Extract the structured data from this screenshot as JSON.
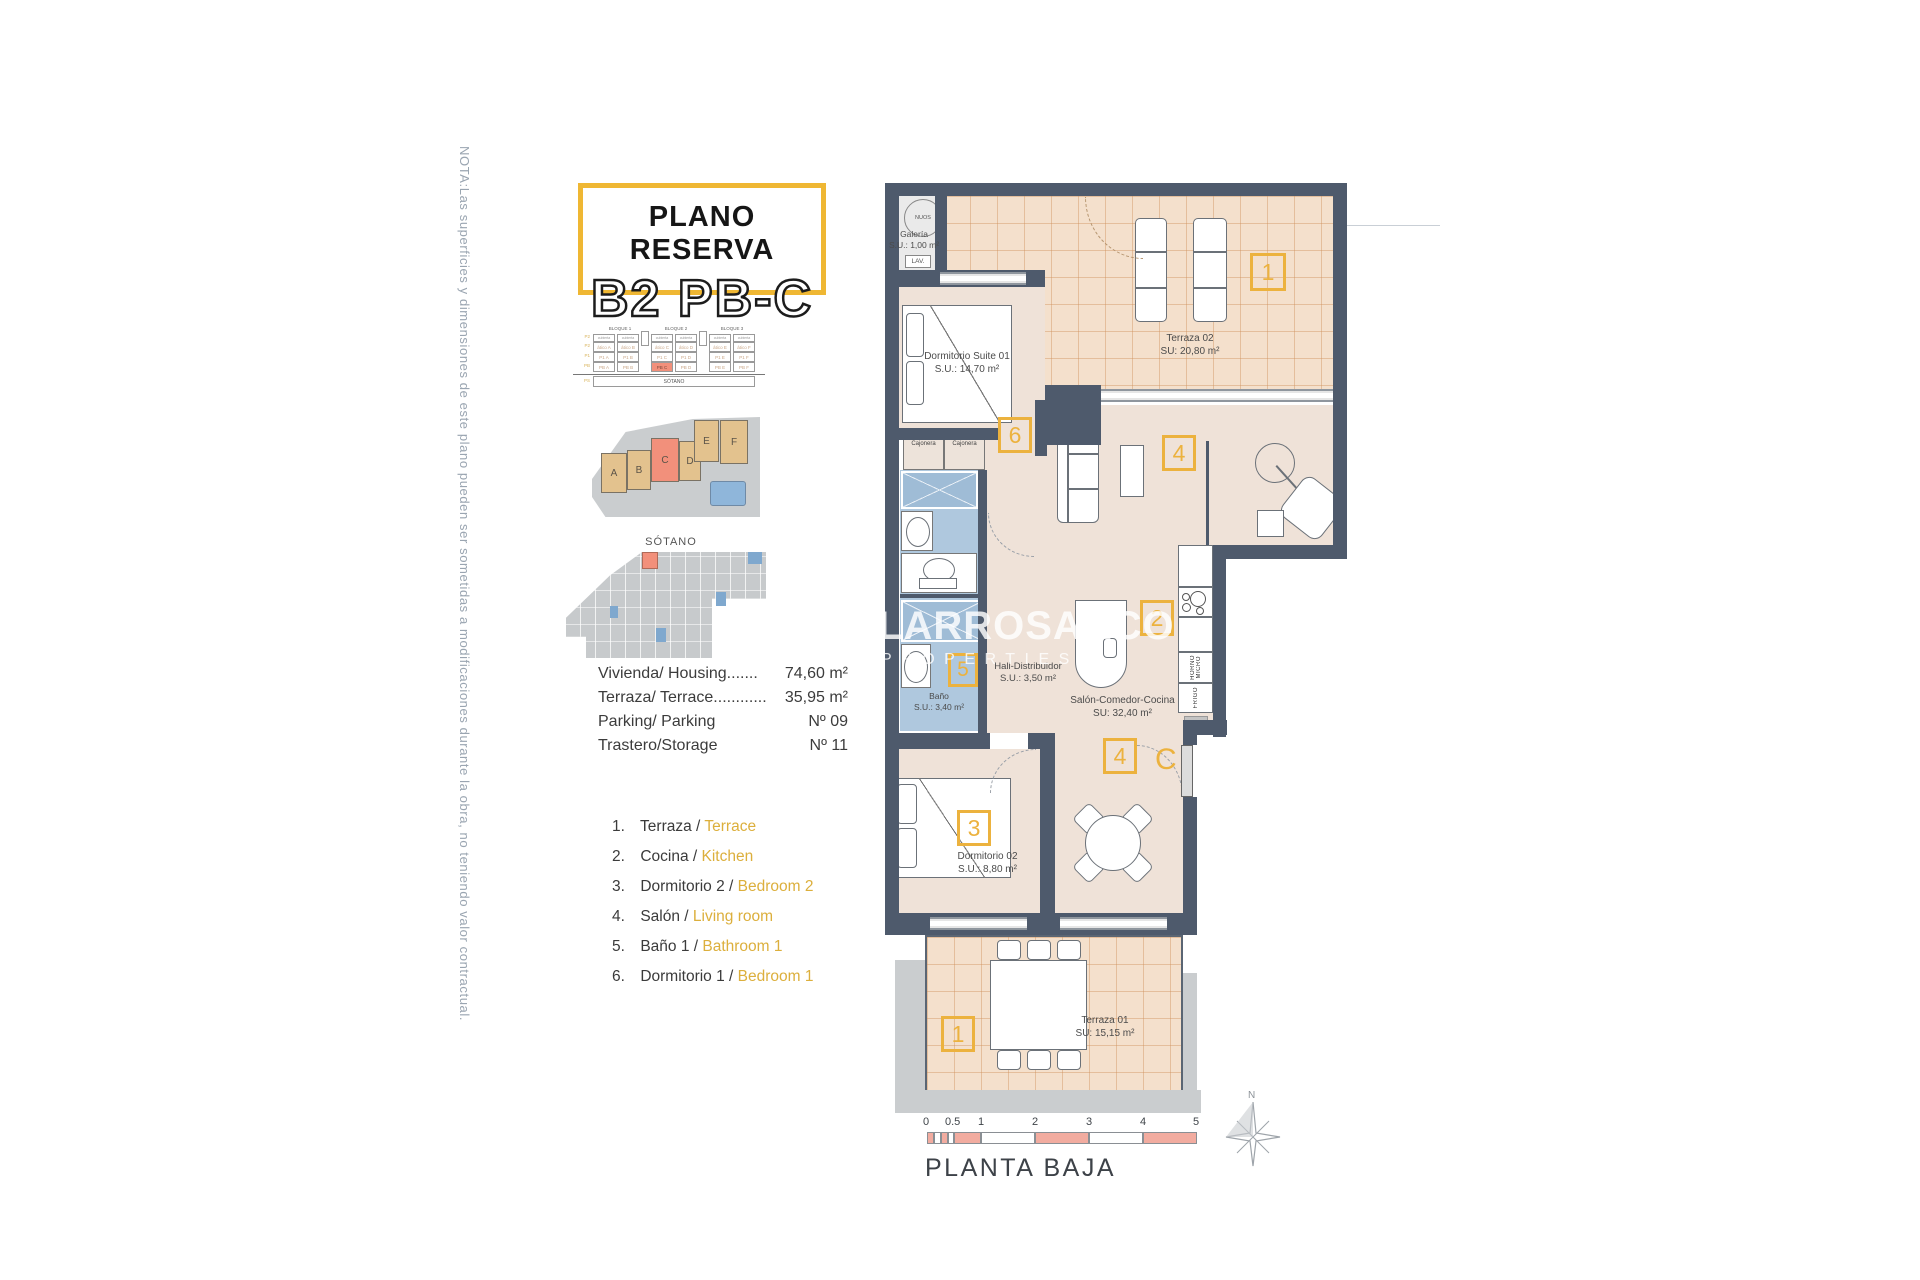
{
  "note": "NOTA:Las superficies y dimensiones de este plano pueden ser sometidas a modificaciones durante la obra, no teniendo valor contractual.",
  "title": {
    "top": "PLANO RESERVA",
    "main": "B2 PB-C"
  },
  "block_table": {
    "bloques": [
      "BLOQUE 1",
      "BLOQUE 2",
      "BLOQUE 3"
    ],
    "row_labels": [
      "P2",
      "P2",
      "P1",
      "PB",
      "PS"
    ],
    "header_cells": [
      "cubierta",
      "cubierta",
      "cubierta",
      "cubierta",
      "cubierta",
      "cubierta"
    ],
    "rows": [
      [
        "ático A",
        "ático B",
        "ático C",
        "ático D",
        "ático E",
        "ático F"
      ],
      [
        "P1 A",
        "P1 B",
        "P1 C",
        "P1 D",
        "P1 E",
        "P1 F"
      ],
      [
        "PB A",
        "PB B",
        "PB C",
        "PB D",
        "PB E",
        "PB F"
      ]
    ],
    "sotano": "SÓTANO"
  },
  "site_plan": {
    "buildings": [
      "A",
      "B",
      "C",
      "D",
      "E",
      "F"
    ]
  },
  "sotano_plan": {
    "label": "SÓTANO"
  },
  "stats": {
    "rows": [
      {
        "label": "Vivienda/ Housing.......",
        "value": "74,60 m²"
      },
      {
        "label": "Terraza/ Terrace............",
        "value": "35,95 m²"
      },
      {
        "label": "Parking/ Parking",
        "value": "Nº 09"
      },
      {
        "label": "Trastero/Storage",
        "value": "Nº 11"
      }
    ]
  },
  "legend": {
    "items": [
      {
        "num": "1.",
        "es": "Terraza /",
        "en": "Terrace"
      },
      {
        "num": "2.",
        "es": "Cocina /",
        "en": "Kitchen"
      },
      {
        "num": "3.",
        "es": "Dormitorio 2 /",
        "en": "Bedroom 2"
      },
      {
        "num": "4.",
        "es": "Salón /",
        "en": "Living room"
      },
      {
        "num": "5.",
        "es": "Baño 1 /",
        "en": "Bathroom 1"
      },
      {
        "num": "6.",
        "es": "Dormitorio 1 /",
        "en": "Bedroom 1"
      }
    ]
  },
  "watermark": {
    "line1": "LARROSA&CO",
    "line2": "PROPERTIES"
  },
  "plan": {
    "galeria": {
      "boiler": "NUOS",
      "name": "Galería",
      "area": "S.U.: 1,00 m²",
      "lav": "LAV."
    },
    "terraza02": {
      "name": "Terraza 02",
      "area": "SU: 20,80 m²"
    },
    "suite": {
      "name": "Dormitorio Suite 01",
      "area": "S.U.: 14,70 m²"
    },
    "cajonera": "Cajonera",
    "hall": {
      "name": "Hall-Distribuidor",
      "area": "S.U.: 3,50 m²"
    },
    "salon": {
      "name": "Salón-Comedor-Cocina",
      "area": "SU: 32,40 m²"
    },
    "bano": {
      "name": "Baño",
      "area": "S.U.: 3,40 m²"
    },
    "dorm02": {
      "name": "Dormitorio 02",
      "area": "S.U.: 8,80 m²"
    },
    "terraza01": {
      "name": "Terraza 01",
      "area": "SU: 15,15 m²"
    },
    "appliances": {
      "horno": "HORNO",
      "micro": "MICRO",
      "frigo": "FRIGO"
    },
    "markers": {
      "terraza02": "1",
      "cocina": "2",
      "dorm2": "3",
      "salon": "4",
      "bano": "5",
      "dorm1": "6",
      "dining": "4",
      "terraza01": "1"
    },
    "unit_letter": "C"
  },
  "footer": {
    "ticks": [
      "0",
      "0.5",
      "1",
      "2",
      "3",
      "4",
      "5"
    ],
    "label": "PLANTA BAJA",
    "north": "N"
  },
  "colors": {
    "accent_gold": "#ECB23E",
    "title_border": "#EFB733",
    "wall": "#4E5A6C",
    "terrace_tile": "#F4E0CC",
    "tile_line": "#D9A97E",
    "interior": "#EFE2D8",
    "bath_blue": "#AFC8DE",
    "bath_blue_dark": "#9FBCD6",
    "highlight_salmon": "#F2907B",
    "site_gray": "#CACDCF",
    "building_tan": "#E3C28E",
    "pool_blue": "#8FB6DA",
    "scalebar_salmon": "#F2ACA0",
    "note_gray": "#9AA5B1",
    "legend_yellow": "#DCAF3C"
  }
}
